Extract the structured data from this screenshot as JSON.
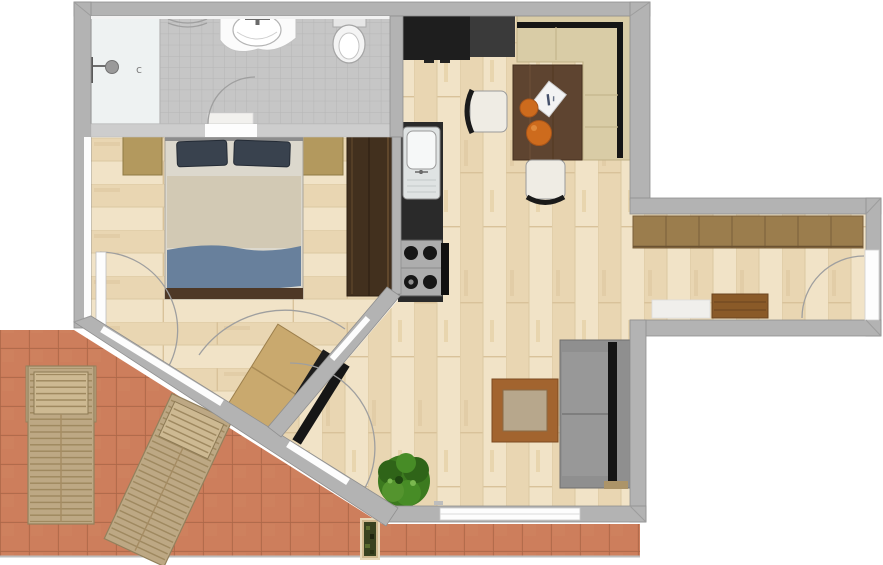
{
  "plan": {
    "type": "apartment-floor-plan-top-view",
    "rooms": [
      {
        "id": "bathroom",
        "items": [
          "shower",
          "shower-head",
          "towel-rail",
          "vanity-sink",
          "faucet",
          "toilet",
          "bath-mat",
          "door-swing"
        ]
      },
      {
        "id": "bedroom",
        "items": [
          "double-bed",
          "pillow-left",
          "pillow-right",
          "nightstand-left",
          "nightstand-right",
          "wardrobe",
          "terrace-door",
          "door-swing"
        ]
      },
      {
        "id": "kitchen",
        "items": [
          "counter-top",
          "counter-dark",
          "kitchen-sink",
          "stove-4-burners",
          "oven-handle"
        ]
      },
      {
        "id": "dining-area",
        "items": [
          "corner-bench",
          "dining-table",
          "chair-left",
          "chair-bottom",
          "orange-small",
          "orange-large",
          "paper-note"
        ]
      },
      {
        "id": "living-area",
        "items": [
          "corner-sofa",
          "coffee-table",
          "potted-plant",
          "desk",
          "bench-black-1",
          "bench-black-2",
          "window"
        ]
      },
      {
        "id": "hallway",
        "items": [
          "wardrobe-row",
          "entry-bench",
          "door-mat",
          "entrance-door",
          "door-swing"
        ]
      },
      {
        "id": "terrace",
        "items": [
          "sun-lounger-straight",
          "sun-lounger-angled",
          "planter-box"
        ]
      }
    ]
  },
  "labels": {
    "shower_drain": "c"
  },
  "colors": {
    "wall": "#b3b3b3",
    "floor_wood": "#ecdbbc",
    "bath_tile": "#c6c6c6",
    "terrace_tile": "#ca7a58",
    "shower": "#eef2f2",
    "kitchen_counter": "#1e1e1e",
    "counter_dark": "#3a3a3a",
    "stove": "#adadad",
    "dining_table": "#5e4430",
    "dining_bench": "#d9cca6",
    "bench_back": "#151515",
    "orange": "#cd6b1d",
    "sofa": "#8f8f8f",
    "sofa_stripe": "#141414",
    "sofa_base": "#ac9468",
    "coffee_frame": "#a2642f",
    "coffee_inset": "#b7a78c",
    "plant": "#3c7a1f",
    "desk": "#c9a96e",
    "bench_black": "#1d1d1d",
    "hall_wardrobe": "#9b7d4d",
    "entry_bench": "#8a5a28",
    "bedroom_wardrobe": "#42301e",
    "nightstand": "#b3995e",
    "bed_pillow": "#39424e",
    "bed_sheet": "#dcd8cd",
    "bed_blanket": "#d2c9b4",
    "bed_throw": "#68809c",
    "bed_frame": "#4e3826",
    "lounger": "#bda884",
    "planter_green": "#39421f"
  }
}
